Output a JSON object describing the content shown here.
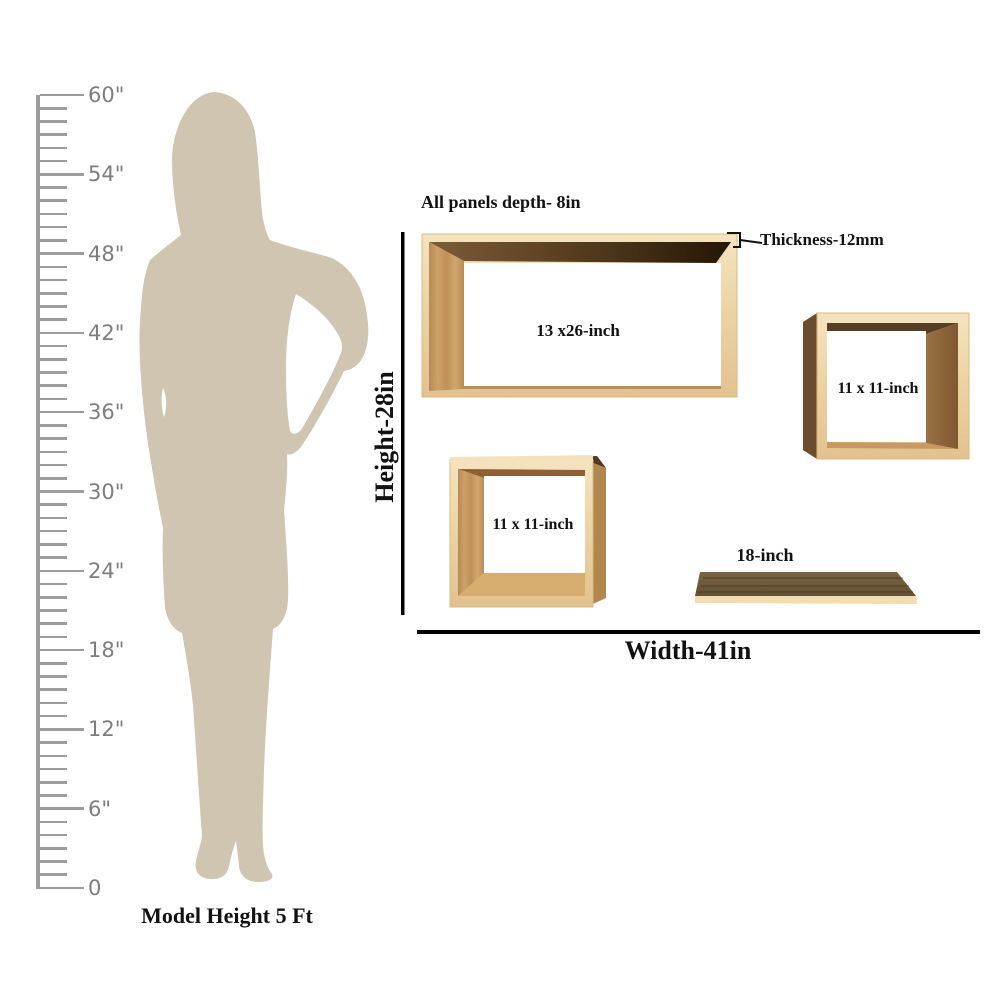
{
  "ruler": {
    "max_inches": 60,
    "minor_every_inch": true,
    "marks": [
      {
        "value": 60,
        "label": "60\""
      },
      {
        "value": 54,
        "label": "54\""
      },
      {
        "value": 48,
        "label": "48\""
      },
      {
        "value": 42,
        "label": "42\""
      },
      {
        "value": 36,
        "label": "36\""
      },
      {
        "value": 30,
        "label": "30\""
      },
      {
        "value": 24,
        "label": "24\""
      },
      {
        "value": 18,
        "label": "18\""
      },
      {
        "value": 12,
        "label": "12\""
      },
      {
        "value": 6,
        "label": "6\""
      },
      {
        "value": 0,
        "label": "0"
      }
    ]
  },
  "model": {
    "caption": "Model Height 5 Ft"
  },
  "diagram": {
    "depth_note": "All panels depth- 8in",
    "thickness_note": "Thickness-12mm",
    "height_label": "Height-28in",
    "width_label": "Width-41in",
    "shelves": {
      "large_rect": {
        "label": "13 x26-inch"
      },
      "square_right": {
        "label": "11 x 11-inch"
      },
      "square_left": {
        "label": "11 x 11-inch"
      },
      "plank": {
        "label": "18-inch"
      }
    }
  },
  "colors": {
    "silhouette": "#cfc5b1",
    "ruler_gray": "#9c9c9c",
    "wood_frame_light": "#ecd2a2",
    "wood_grain_medium": "#c89c62",
    "wood_side_dark": "#6b4d2d",
    "dimension_line": "#000000"
  }
}
